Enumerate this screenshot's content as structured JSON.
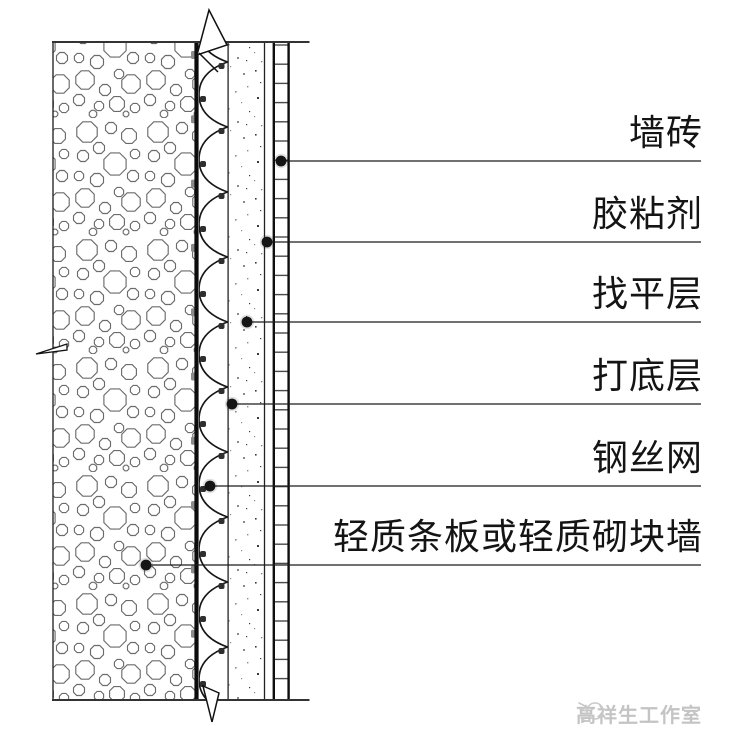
{
  "diagram": {
    "type": "construction-detail-section",
    "description": "wall tile finish on lightweight wall, vertical section detail",
    "callouts": [
      {
        "label": "墙砖",
        "line_y": 161,
        "dot_x": 281,
        "dot_y": 161,
        "end_x": 701
      },
      {
        "label": "胶粘剂",
        "line_y": 242,
        "dot_x": 267,
        "dot_y": 242,
        "end_x": 701
      },
      {
        "label": "找平层",
        "line_y": 322,
        "dot_x": 247,
        "dot_y": 322,
        "end_x": 701
      },
      {
        "label": "打底层",
        "line_y": 404,
        "dot_x": 232,
        "dot_y": 404,
        "end_x": 701
      },
      {
        "label": "钢丝网",
        "line_y": 486,
        "dot_x": 210,
        "dot_y": 486,
        "end_x": 701
      },
      {
        "label": "轻质条板或轻质砌块墙",
        "line_y": 565,
        "dot_x": 146,
        "dot_y": 565,
        "end_x": 701
      }
    ],
    "watermark": {
      "text": "高祥生工作室",
      "icon": "bird-sketch-icon"
    },
    "colors": {
      "ink": "#1c1c1c",
      "hatch_gray": "#6b6b6b",
      "rung_gray": "#4a4a4a",
      "anchor_gray": "#8b8b8b",
      "watermark_gray": "#c4c4c4"
    }
  }
}
